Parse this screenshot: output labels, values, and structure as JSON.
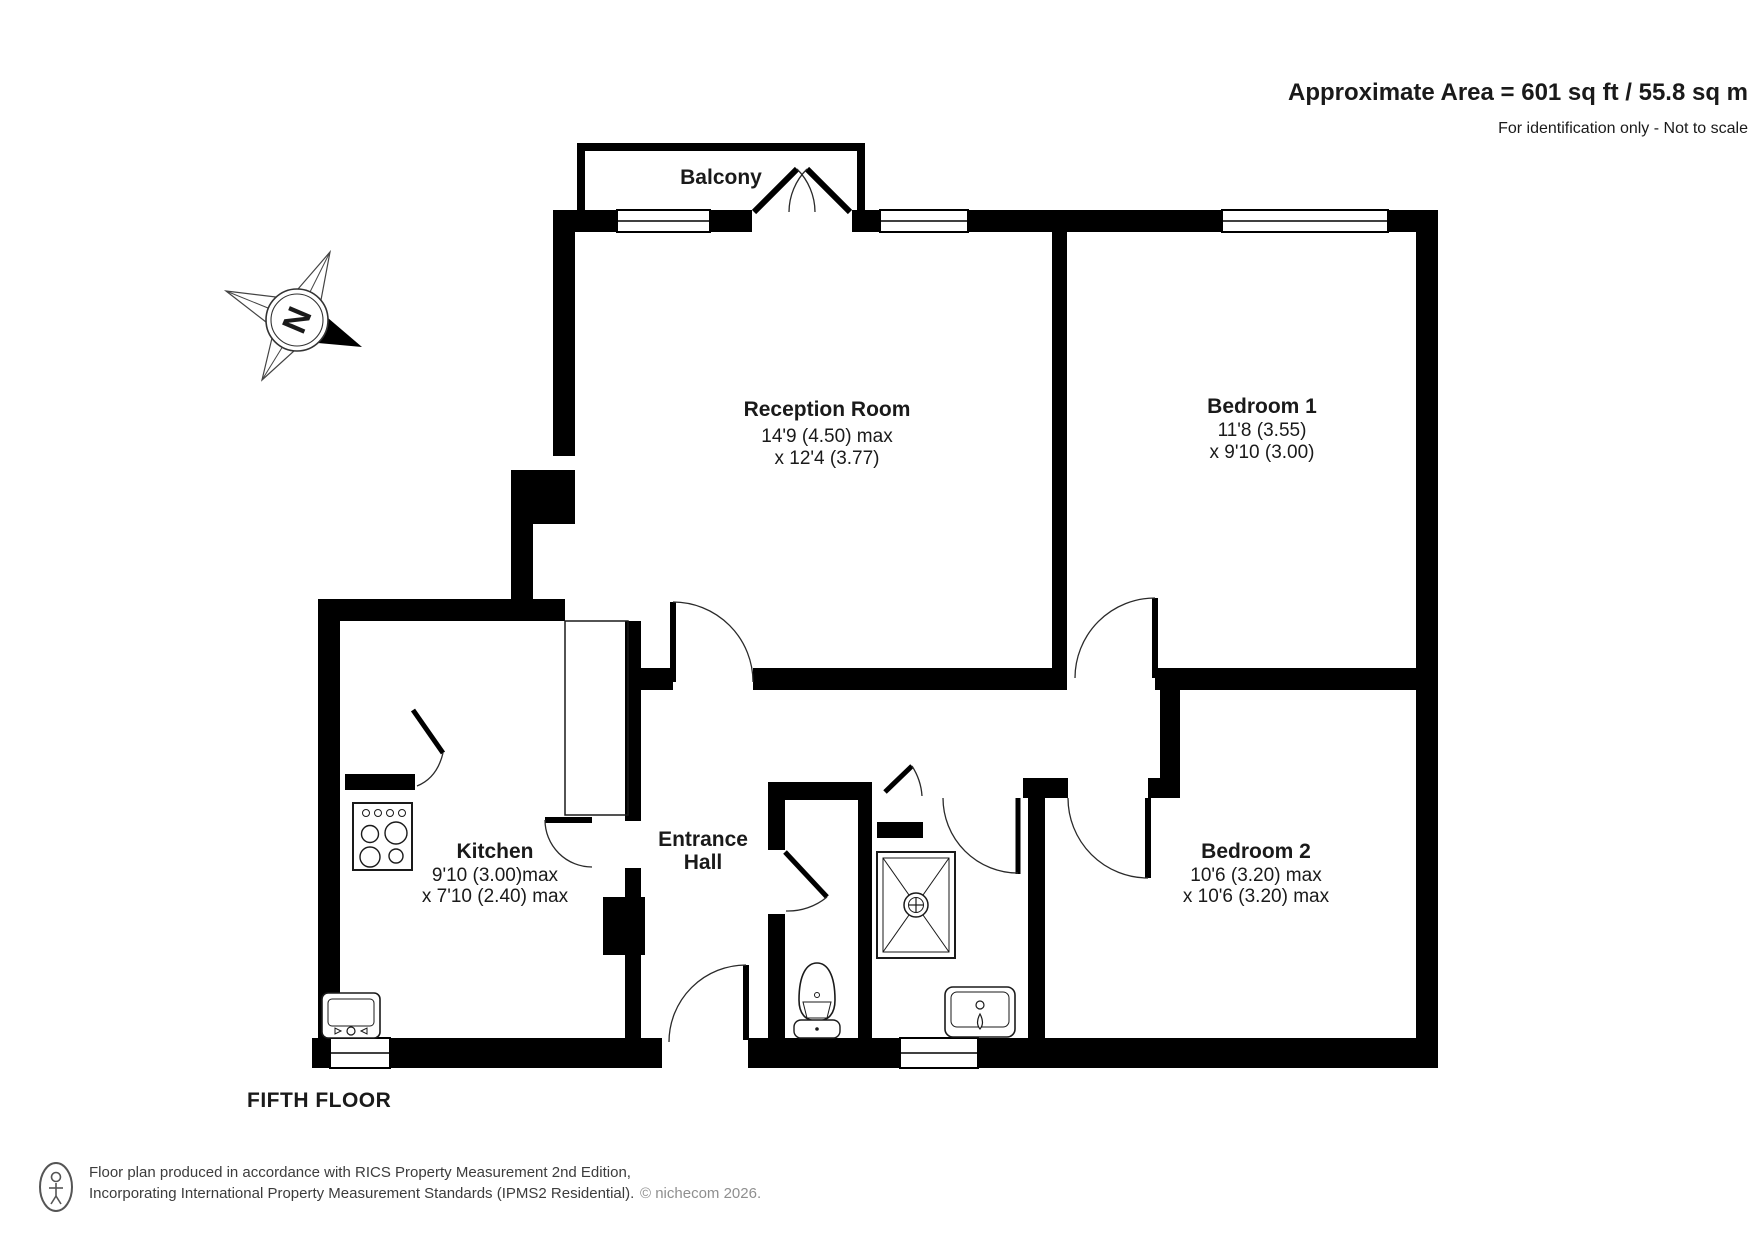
{
  "header": {
    "area_text": "Approximate Area = 601 sq ft / 55.8 sq m",
    "disclaimer": "For identification only - Not to scale"
  },
  "compass": {
    "north_letter": "N"
  },
  "rooms": {
    "balcony": {
      "name": "Balcony"
    },
    "reception": {
      "name": "Reception Room",
      "dim1": "14'9 (4.50) max",
      "dim2": "x 12'4 (3.77)"
    },
    "bedroom1": {
      "name": "Bedroom 1",
      "dim1": "11'8 (3.55)",
      "dim2": "x 9'10 (3.00)"
    },
    "bedroom2": {
      "name": "Bedroom 2",
      "dim1": "10'6 (3.20) max",
      "dim2": "x 10'6 (3.20) max"
    },
    "kitchen": {
      "name": "Kitchen",
      "dim1": "9'10 (3.00)max",
      "dim2": "x 7'10 (2.40) max"
    },
    "hall": {
      "line1": "Entrance",
      "line2": "Hall"
    }
  },
  "floor_label": "FIFTH FLOOR",
  "footer": {
    "line1": "Floor plan produced in accordance with RICS Property Measurement 2nd Edition,",
    "line2": "Incorporating International Property Measurement Standards (IPMS2 Residential).",
    "credit": "© nichecom 2026."
  },
  "colors": {
    "wall": "#000000",
    "text": "#1a1a1a",
    "credit": "#8f8f8f"
  }
}
